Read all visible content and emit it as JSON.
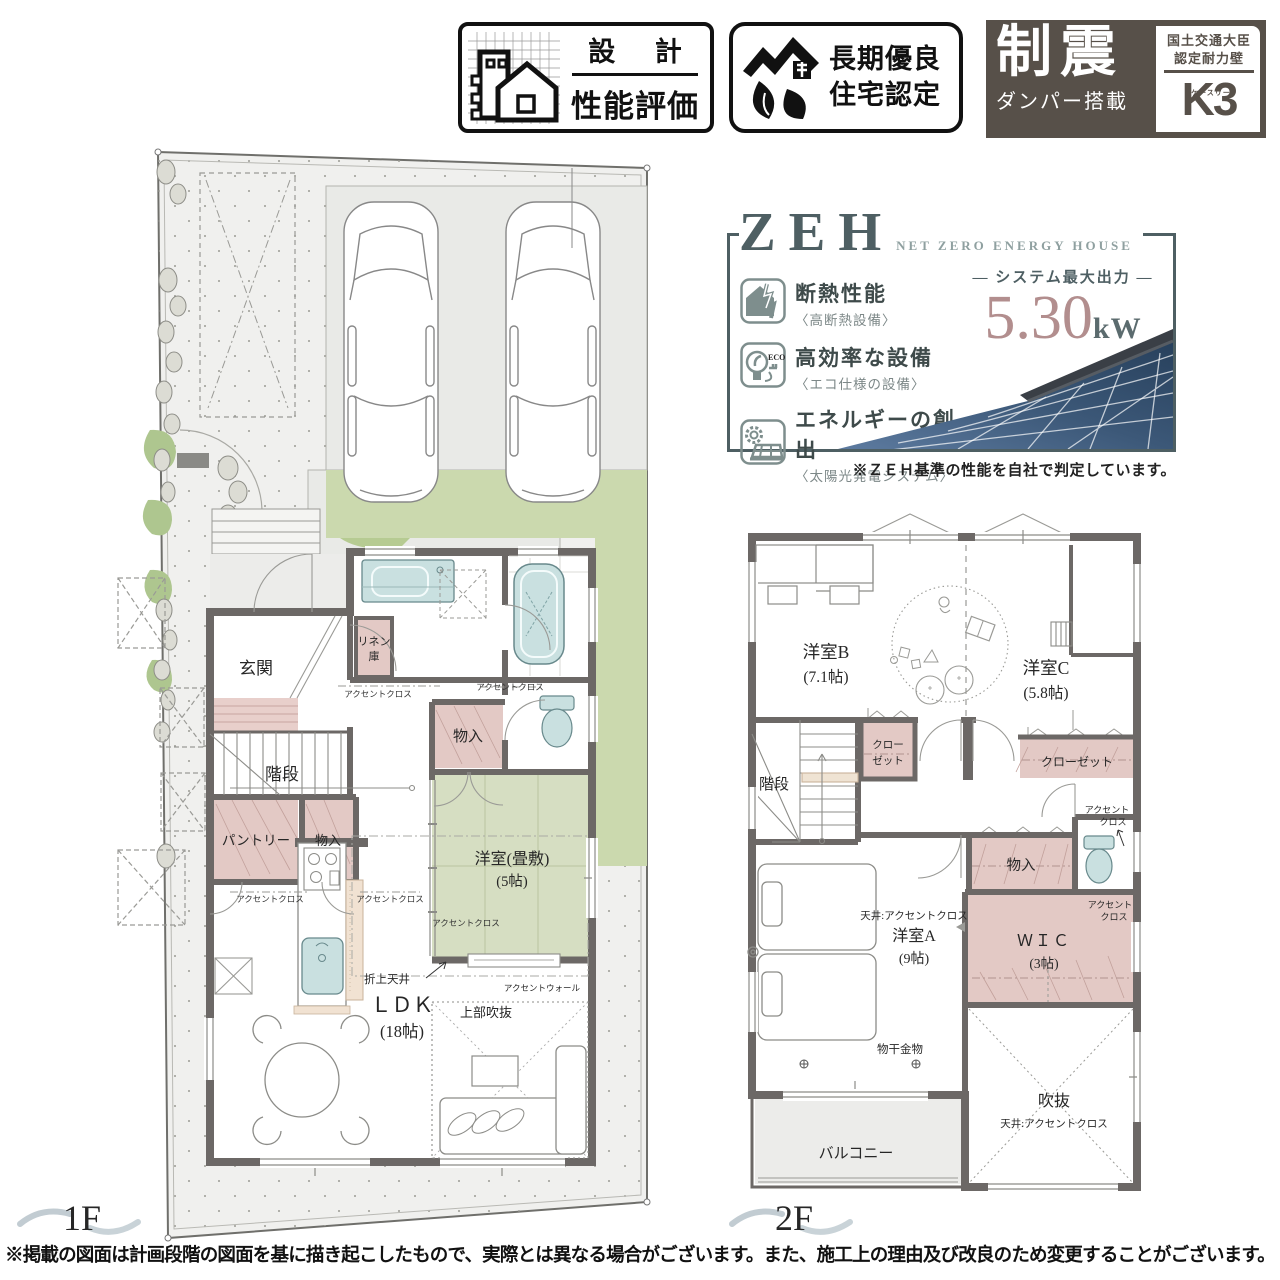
{
  "header_badges": {
    "design_eval": {
      "top": "設 計",
      "bottom": "性能評価"
    },
    "long_term": {
      "line1": "長期優良",
      "line2": "住宅認定"
    },
    "seismic": {
      "main": "制震",
      "sub": "ダンパー搭載",
      "cert_line1": "国土交通大臣",
      "cert_line2": "認定耐力壁",
      "logo": "K3",
      "logo_kana": "ケースリー"
    }
  },
  "zeh": {
    "title": "ZEH",
    "subtitle": "NET ZERO ENERGY HOUSE",
    "features": [
      {
        "label": "断熱性能",
        "sub": "〈高断熱設備〉"
      },
      {
        "label": "高効率な設備",
        "sub": "〈エコ仕様の設備〉"
      },
      {
        "label": "エネルギーの創出",
        "sub": "〈太陽光発電システム〉"
      }
    ],
    "output_label": "― システム最大出力 ―",
    "output_value": "5.30",
    "output_unit": "kW",
    "note": "※ＺＥＨ基準の性能を自社で判定しています。"
  },
  "floor1": {
    "name": "1F",
    "rooms": {
      "genkan": "玄関",
      "kaidan": "階段",
      "pantry": "パントリー",
      "monoiri": "物入",
      "monoiri2": "物入",
      "linen1": "リネン",
      "linen2": "庫",
      "tatami1": "洋室(畳敷)",
      "tatami2": "(5帖)",
      "ldk1": "ＬＤＫ",
      "ldk2": "(18帖)",
      "fukinuke": "上部吹抜",
      "oriage": "折上天井",
      "accent_wall": "アクセントウォール",
      "accent": "アクセントクロス"
    }
  },
  "floor2": {
    "name": "2F",
    "rooms": {
      "b1": "洋室B",
      "b2": "(7.1帖)",
      "c1": "洋室C",
      "c2": "(5.8帖)",
      "kaidan": "階段",
      "closet_l1": "クロー",
      "closet_l2": "ゼット",
      "closet_r": "クローゼット",
      "monoiri": "物入",
      "accent1": "アクセント",
      "accent2": "クロス",
      "wic1": "ＷＩＣ",
      "wic2": "(3帖)",
      "a_ceiling": "天井:アクセントクロス",
      "a1": "洋室A",
      "a2": "(9帖)",
      "monohoshi": "物干金物",
      "fukinuke": "吹抜",
      "fukinuke_ceiling": "天井:アクセントクロス",
      "balcony": "バルコニー"
    }
  },
  "footer": {
    "disclaimer": "※掲載の図面は計画段階の図面を基に描き起こしたもので、実際とは異なる場合がございます。また、施工上の理由及び改良のため変更することがございます。"
  }
}
